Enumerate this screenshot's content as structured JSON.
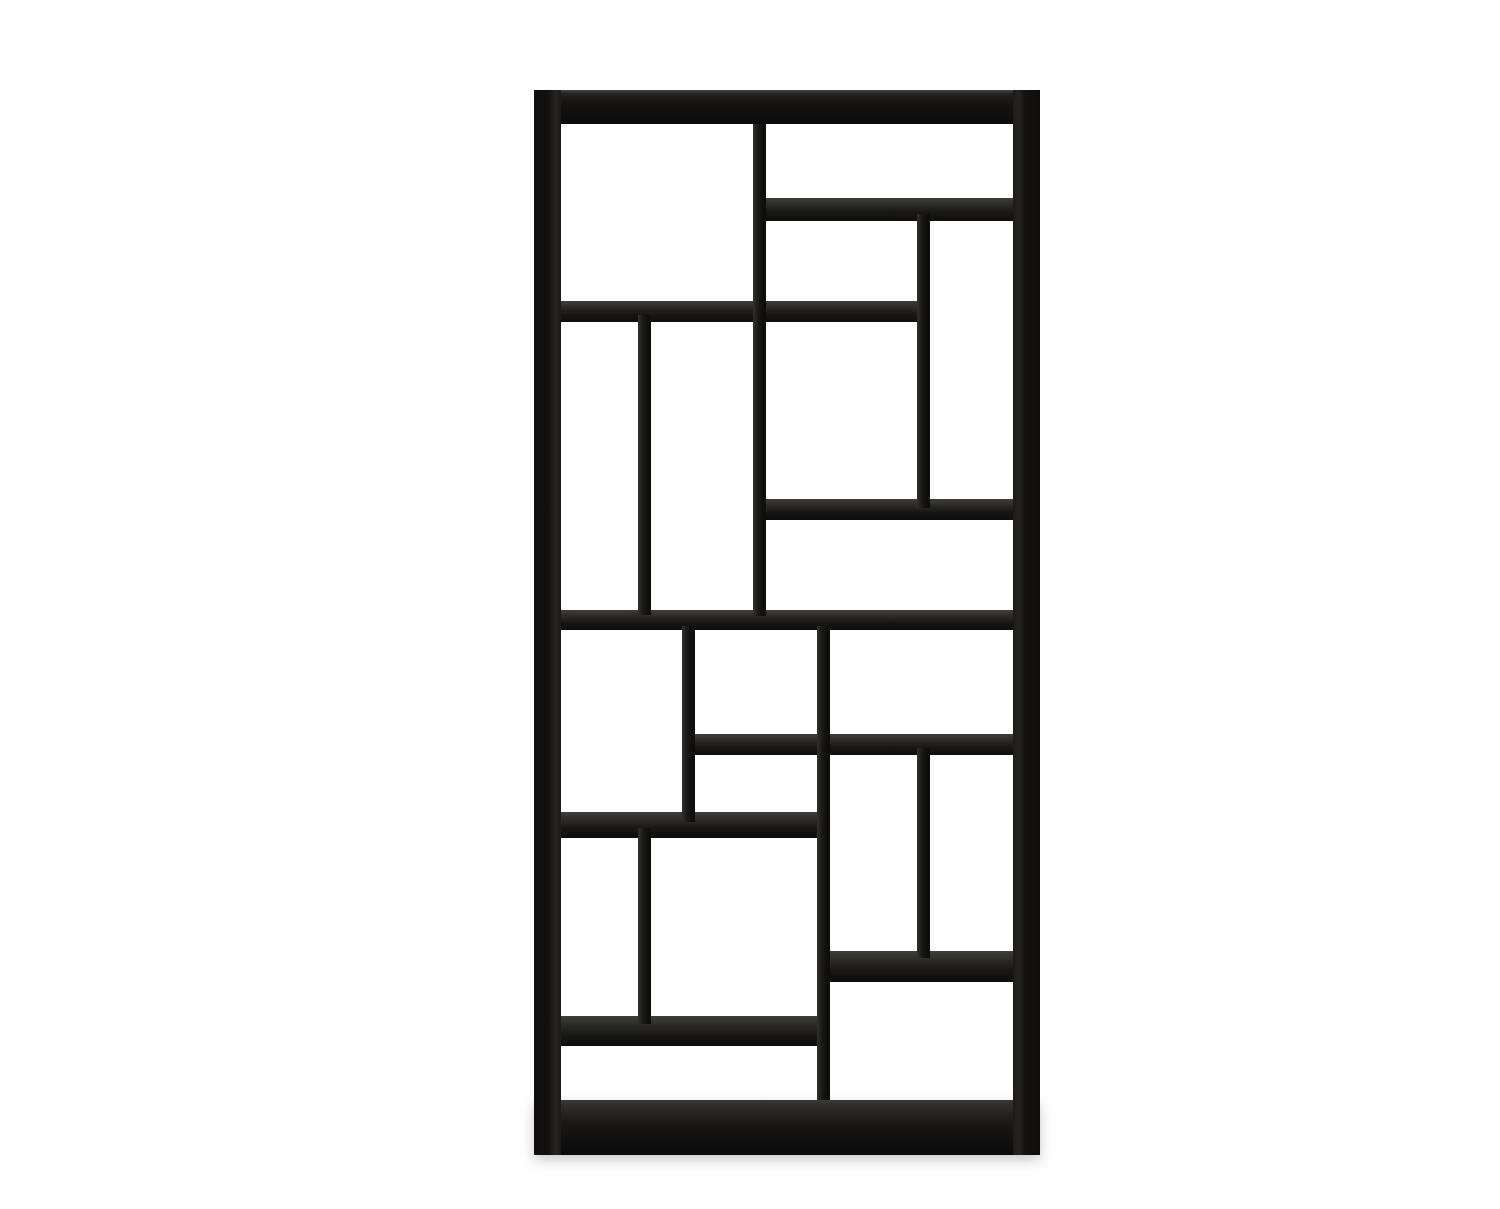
{
  "scene": {
    "type": "product-photograph",
    "subject": "black wooden asymmetric open bookshelf (Mondrian-style staggered cube rack)",
    "background_color": "#ffffff",
    "wood_color_darkest": "#0c0b0a",
    "wood_color_dark": "#161514",
    "wood_color_mid": "#2b2a27",
    "wood_color_highlight": "#4b4946",
    "canvas": {
      "width": 1500,
      "height": 1209
    }
  },
  "shelf_unit": {
    "bounding_box": {
      "x": 534,
      "y": 90,
      "width": 506,
      "height": 1065
    },
    "bars": [
      {
        "name": "shelf-top-right",
        "kind": "shelf",
        "x": 760,
        "y": 198,
        "w": 255,
        "h": 23
      },
      {
        "name": "shelf-upper-left",
        "kind": "shelf",
        "x": 556,
        "y": 301,
        "w": 374,
        "h": 21
      },
      {
        "name": "shelf-mid-right",
        "kind": "shelf",
        "x": 758,
        "y": 499,
        "w": 257,
        "h": 21
      },
      {
        "name": "shelf-middle-full",
        "kind": "shelf",
        "x": 556,
        "y": 610,
        "w": 459,
        "h": 20
      },
      {
        "name": "shelf-lower-mid-right",
        "kind": "shelf",
        "x": 688,
        "y": 734,
        "w": 327,
        "h": 21
      },
      {
        "name": "shelf-lower-left",
        "kind": "shelf",
        "x": 556,
        "y": 812,
        "w": 268,
        "h": 26
      },
      {
        "name": "shelf-right-low",
        "kind": "shelf",
        "x": 820,
        "y": 951,
        "w": 195,
        "h": 31
      },
      {
        "name": "shelf-bottom-left",
        "kind": "shelf",
        "x": 556,
        "y": 1016,
        "w": 268,
        "h": 30
      },
      {
        "name": "divider-top-center",
        "kind": "divider",
        "x": 753,
        "y": 124,
        "w": 13,
        "h": 492
      },
      {
        "name": "divider-upper-right",
        "kind": "divider",
        "x": 917,
        "y": 214,
        "w": 13,
        "h": 294
      },
      {
        "name": "divider-upper-left",
        "kind": "divider",
        "x": 638,
        "y": 315,
        "w": 13,
        "h": 300
      },
      {
        "name": "divider-mid-left",
        "kind": "divider",
        "x": 682,
        "y": 626,
        "w": 13,
        "h": 196
      },
      {
        "name": "divider-mid-long",
        "kind": "divider",
        "x": 817,
        "y": 626,
        "w": 13,
        "h": 482
      },
      {
        "name": "divider-lower-right",
        "kind": "divider",
        "x": 917,
        "y": 748,
        "w": 13,
        "h": 210
      },
      {
        "name": "divider-bottom-left",
        "kind": "divider",
        "x": 638,
        "y": 828,
        "w": 13,
        "h": 196
      },
      {
        "name": "frame-top",
        "kind": "frame-top",
        "x": 534,
        "y": 90,
        "w": 506,
        "h": 34
      },
      {
        "name": "frame-left",
        "kind": "frame-left",
        "x": 534,
        "y": 90,
        "w": 27,
        "h": 1065
      },
      {
        "name": "frame-right",
        "kind": "frame-right",
        "x": 1013,
        "y": 90,
        "w": 27,
        "h": 1065
      },
      {
        "name": "frame-bottom",
        "kind": "frame-bottom",
        "x": 534,
        "y": 1100,
        "w": 506,
        "h": 55
      }
    ]
  }
}
